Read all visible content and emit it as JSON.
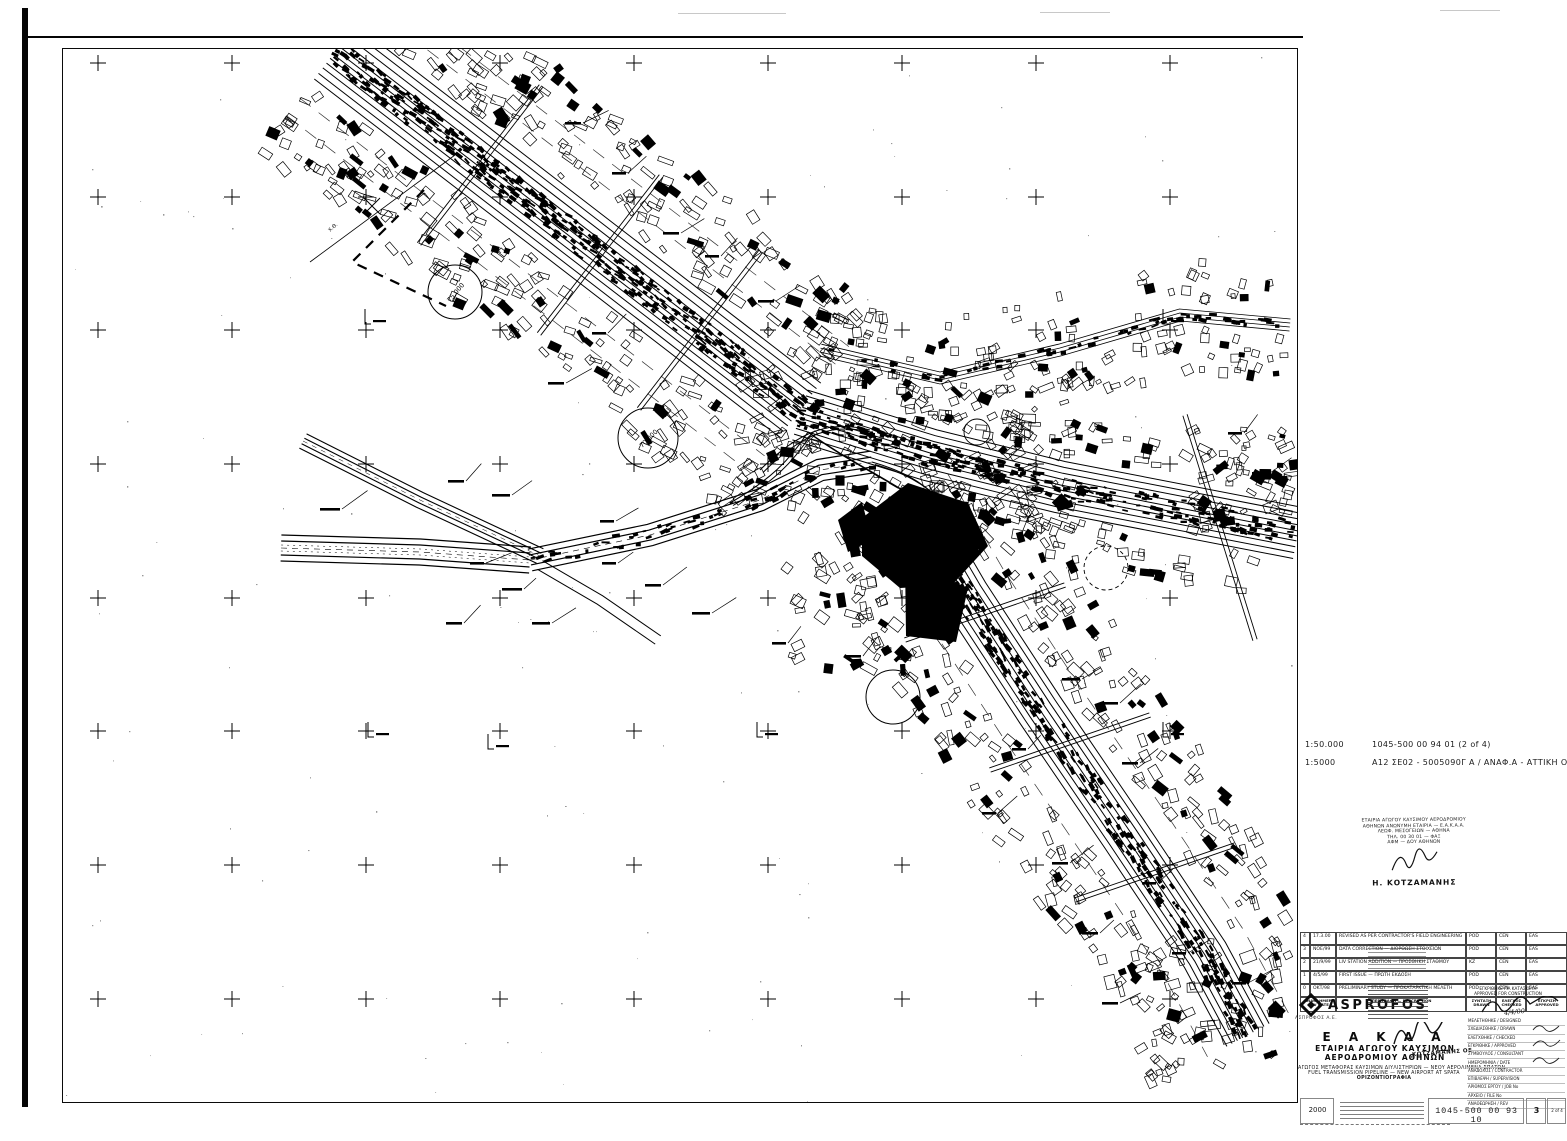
{
  "references": [
    {
      "scale": "1:50.000",
      "ref": "1045-500 00 94 01  (2 of 4)"
    },
    {
      "scale": "1:5000",
      "ref": "Α12 ΣΕ02 - 5005090Γ Α / ΑΝΑΦ.Α - ΑΤΤΙΚΗ ΟΔΟΣ :"
    }
  ],
  "map": {
    "station_circle_1": "75.000",
    "station_circle_2": "70.000",
    "chainage_label": "Χ.Θ."
  },
  "stamp": {
    "lines": [
      "ΕΤΑΙΡΙΑ ΑΓΩΓΟΥ ΚΑΥΣΙΜΟΥ ΑΕΡΟΔΡΟΜΙΟΥ",
      "ΑΘΗΝΩΝ ΑΝΩΝΥΜΗ ΕΤΑΙΡΙΑ — Ε.Α.Κ.Α.Α.",
      "ΛΕΩΦ. ΜΕΣΟΓΕΙΩΝ — ΑΘΗΝΑ",
      "ΤΗΛ. 00 30 01 — ΦΑΞ",
      "ΑΦΜ — ΔΟΥ ΑΘΗΝΩΝ"
    ],
    "name": "Η. ΚΟΤΖΑΜΑΝΗΣ"
  },
  "revisions": {
    "rows": [
      {
        "no": "4",
        "date": "17.3.00",
        "desc": "REVISED AS PER CONTRACTOR'S FIELD ENGINEERING",
        "c1": "POD",
        "c2": "CEN",
        "c3": "EAS"
      },
      {
        "no": "3",
        "date": "ΝΟΕ/99",
        "desc": "DATA CORRECTION — ΔΙΟΡΘΩΣΗ ΣΤΟΙΧΕΙΩΝ",
        "c1": "POD",
        "c2": "CEN",
        "c3": "EAS"
      },
      {
        "no": "2",
        "date": "21/9/99",
        "desc": "LIV STATION ADDITION — ΠΡΟΣΘΗΚΗ ΣΤΑΘΜΟΥ",
        "c1": "KZ",
        "c2": "CEN",
        "c3": "EAS"
      },
      {
        "no": "1",
        "date": "4/5/99",
        "desc": "FIRST ISSUE — ΠΡΩΤΗ ΕΚΔΟΣΗ",
        "c1": "POD",
        "c2": "CEN",
        "c3": "EAS"
      },
      {
        "no": "0",
        "date": "ΟΚΤ/98",
        "desc": "PRELIMINARY STUDY — ΠΡΟΚΑΤΑΡΚΤΙΚΗ ΜΕΛΕΤΗ",
        "c1": "POD",
        "c2": "CEN",
        "c3": "EAS"
      }
    ],
    "left_header": "ΑΝΑΘ. ΗΜΕΡ. REV DATE",
    "desc_header": "ΠΕΡΙΓΡΑΦΗ — DESCRIPTION",
    "col_headers": [
      "ΣΥΝΤΑΞΗ DRAWN",
      "ΕΛΕΓΧΟΣ CHECKED",
      "ΕΓΚΡΙΣΗ APPROVED"
    ]
  },
  "afc": {
    "line1": "ΕΓΚΡΙΘΗΚΕ ΓΙΑ ΚΑΤΑΣΚΕΥΗ",
    "line2": "APPROVED FOR CONSTRUCTION",
    "date": "4/4/00"
  },
  "logo": {
    "name": "ASPROFOS",
    "sub": "ΑΣΠΡΟΦΟΣ Α.Ε."
  },
  "company": {
    "acronym": "Ε Α Κ Α Α",
    "line1": "ΕΤΑΙΡΙΑ ΑΓΩΓΟΥ ΚΑΥΣΙΜΩΝ",
    "line2": "ΑΕΡΟΔΡΟΜΙΟΥ ΑΘΗΝΩΝ",
    "stamp_name": "ΚΟΤΖΑΜΑΝΗΣ ΟΕ"
  },
  "title": {
    "line1": "ΑΓΩΓΟΣ ΜΕΤΑΦΟΡΑΣ ΚΑΥΣΙΜΩΝ ΔΙΥΛΙΣΤΗΡΙΩΝ — ΝΕΟΥ ΑΕΡΟΛΙΜΕΝΑ ΣΠΑΤΩΝ",
    "line2": "FUEL TRANSMISSION PIPELINE — NEW AIRPORT AT SPATA",
    "line3": "ΟΡΙΖΟΝΤΙΟΓΡΑΦΙΑ"
  },
  "bottom": {
    "scale": "2000",
    "number": "1045-500 00 93 10",
    "sheet": "3",
    "pages": "2 of 4"
  },
  "right_labels": [
    "ΜΕΛΕΤΗΘΗΚΕ / DESIGNED",
    "ΣΧΕΔΙΑΣΘΗΚΕ / DRAWN",
    "ΕΛΕΓΧΘΗΚΕ / CHECKED",
    "ΕΓΚΡΙΘΗΚΕ / APPROVED",
    "ΣΥΜΒΟΥΛΟΣ / CONSULTANT",
    "ΗΜΕΡΟΜΗΝΙΑ / DATE",
    "ΑΝΑΔΟΧΟΣ / CONTRACTOR",
    "ΕΠΙΒΛΕΨΗ / SUPERVISION",
    "ΑΡΙΘΜΟΣ ΕΡΓΟΥ / JOB No",
    "ΑΡΧΕΙΟ / FILE No",
    "ΑΝΑΘΕΩΡΗΣΗ / REV"
  ]
}
